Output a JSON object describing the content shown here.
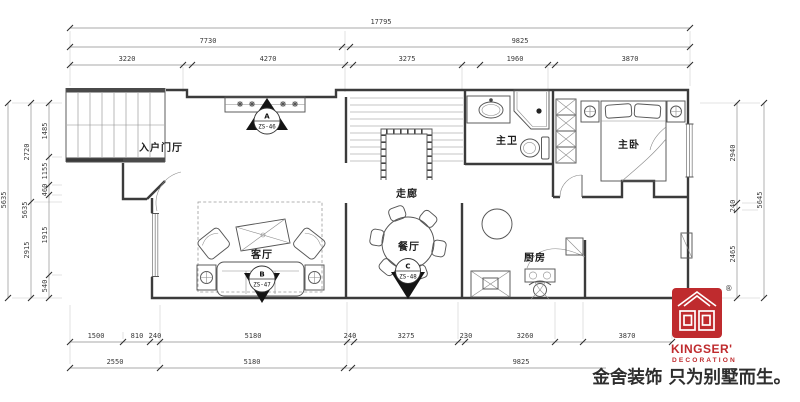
{
  "dims": {
    "top_total": "17795",
    "top_mid": [
      "7730",
      "9825"
    ],
    "top_detail": [
      "3220",
      "4270",
      "3275",
      "1960",
      "3870"
    ],
    "left_total": "5635",
    "left_mid": [
      "2720",
      "5635",
      "2915"
    ],
    "left_detail": [
      "1485",
      "1155",
      "460",
      "1915",
      "540"
    ],
    "right_detail": [
      "2940",
      "240",
      "2465"
    ],
    "right_total": "5645",
    "bottom_detail": [
      "1500",
      "810",
      "240",
      "5180",
      "240",
      "3275",
      "230",
      "3260",
      "3870"
    ],
    "bottom_mid": [
      "2550",
      "5180",
      "9825"
    ]
  },
  "rooms": {
    "entry": "入户门厅",
    "living": "客厅",
    "corridor": "走廊",
    "dining": "餐厅",
    "master_bath": "主卫",
    "master_bedroom": "主卧",
    "kitchen": "厨房"
  },
  "markers": {
    "a": {
      "letter": "A",
      "code": "ZS-46"
    },
    "b": {
      "letter": "B",
      "code": "ZS-47"
    },
    "c": {
      "letter": "C",
      "code": "ZS-48"
    }
  },
  "branding": {
    "name": "KINGSER'",
    "subtitle": "DECORATION",
    "registered": "®",
    "slogan": "金舍装饰 只为别墅而生。",
    "brand_red": "#bf2b2e"
  }
}
